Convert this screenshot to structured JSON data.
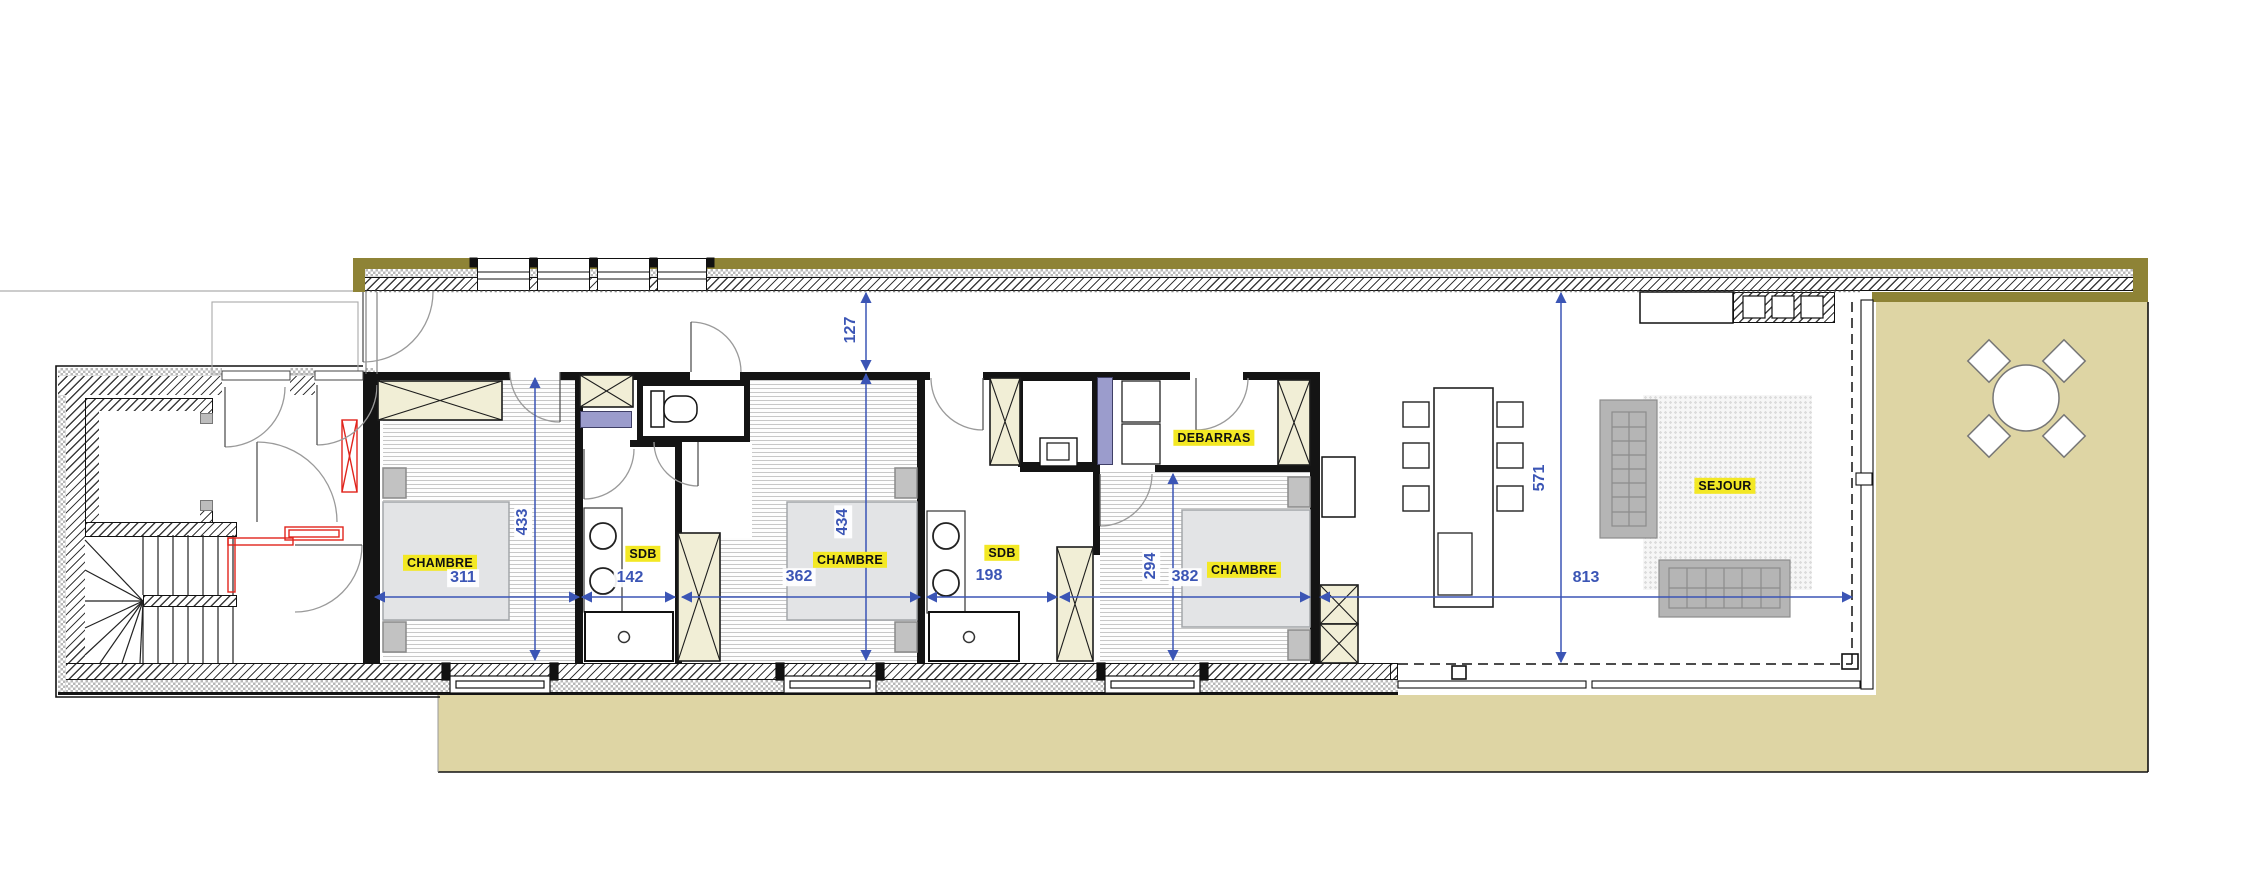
{
  "plan": {
    "type": "architect-floor-plan",
    "rooms": {
      "chambre1": {
        "label": "CHAMBRE"
      },
      "sdb1": {
        "label": "SDB"
      },
      "chambre2": {
        "label": "CHAMBRE"
      },
      "sdb2": {
        "label": "SDB"
      },
      "chambre3": {
        "label": "CHAMBRE"
      },
      "debarras": {
        "label": "DEBARRAS"
      },
      "sejour": {
        "label": "SEJOUR"
      }
    },
    "dims": {
      "d311": "311",
      "d433": "433",
      "d142": "142",
      "d362": "362",
      "d434": "434",
      "d198": "198",
      "d294": "294",
      "d382": "382",
      "d813": "813",
      "d571": "571",
      "d127": "127"
    },
    "colors": {
      "accent_blue": "#3b55b5",
      "label_yellow": "#f3e824",
      "terrace_khaki": "#ded5a4",
      "olive_wall": "#8e8336",
      "purple_fixture": "#9b9ccc",
      "red_markup": "#e0241c",
      "wardrobe_cream": "#f1eed6"
    }
  }
}
